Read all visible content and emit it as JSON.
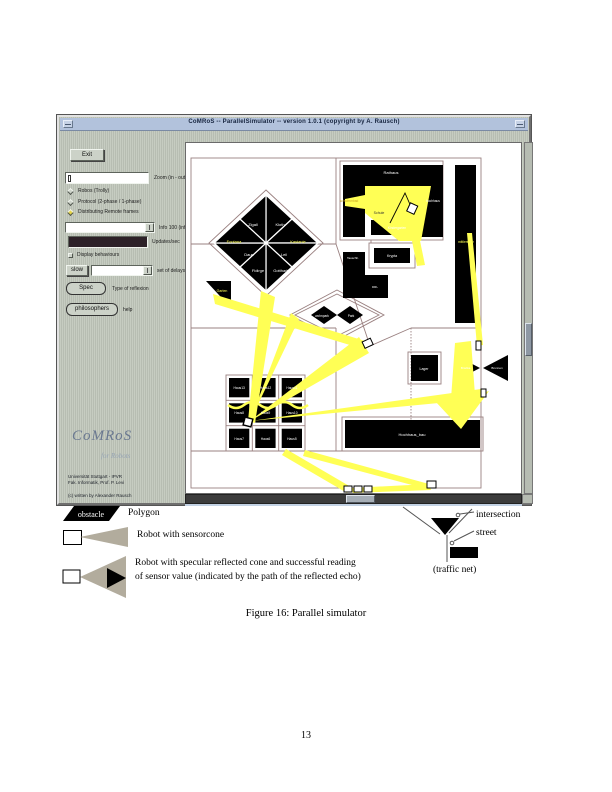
{
  "colors": {
    "sensor_yellow": "#ffff55",
    "titlebar_blue": "#b2c2dc",
    "panel_gray": "#c0c6bb",
    "map_line": "#9a8080",
    "cone_gray": "#b2ac9d"
  },
  "window": {
    "title": "CoMRoS -- ParallelSimulator -- version 1.0.1 (copyright by A. Rausch)",
    "panel": {
      "exit": "Exit",
      "zoom_value": "",
      "zoom_label": "Zoom (in - out)",
      "radios": [
        "Robos (Trolly)",
        "Protocol (2-phase / 1-phase)",
        "Distributing Remote frames"
      ],
      "info_label": "Info 100 (info-trail)",
      "updates_label": "Updates/sec",
      "display_label": "Display behaviours",
      "slow": "slow",
      "delay_label": "set of delays",
      "spec": "Spec",
      "spec_label": "Type of reflexion",
      "philosophers": "philosophers",
      "philosophers_label": "help",
      "logo_title": "CoMRoS",
      "logo_sub": "for Robots",
      "credits": [
        "Universität Stuttgart - IPVR",
        "Fak. Informatik, Prof. P. Levi",
        "(c) written by Alexander Rausch"
      ]
    },
    "map": {
      "rathaus": "Rathaus",
      "schwimmbad": "schwimmbad",
      "hochhaus": "hochhaus",
      "schule": "Schule",
      "kindergarten": "Kindergarten",
      "krypta": "Krypta",
      "tauschhalle": "Tauschh.",
      "drl": "DRL",
      "strasse": "mittlere_str",
      "wohnpark": "wohnpark",
      "park": "Park",
      "garten": "Garten",
      "lager": "Lager",
      "briefkasten": "Briefka.",
      "brunnen": "Brunnen",
      "hochhaus_bau": "Hochhaus_bau",
      "diamond": [
        "Zigall",
        "Kloth",
        "Fontana",
        "Kastanie",
        "Daun",
        "Leil",
        "Fidirge",
        "Gottharb"
      ],
      "houses": [
        "Haus13",
        "Haus12",
        "Haus11",
        "Haus8",
        "Haus9",
        "Haus10",
        "Haus7",
        "Haus6",
        "Haus5"
      ]
    }
  },
  "legend": {
    "obstacle": "obstacle",
    "polygon": "Polygon",
    "sensorcone": "Robot with sensorcone",
    "specular_1": "Robot with specular reflected cone and successful reading",
    "specular_2": "of sensor value (indicated by the path of the reflected echo)",
    "intersection": "intersection",
    "street": "street",
    "traffic_net": "(traffic net)"
  },
  "caption": "Figure 16: Parallel simulator",
  "page_number": "13"
}
